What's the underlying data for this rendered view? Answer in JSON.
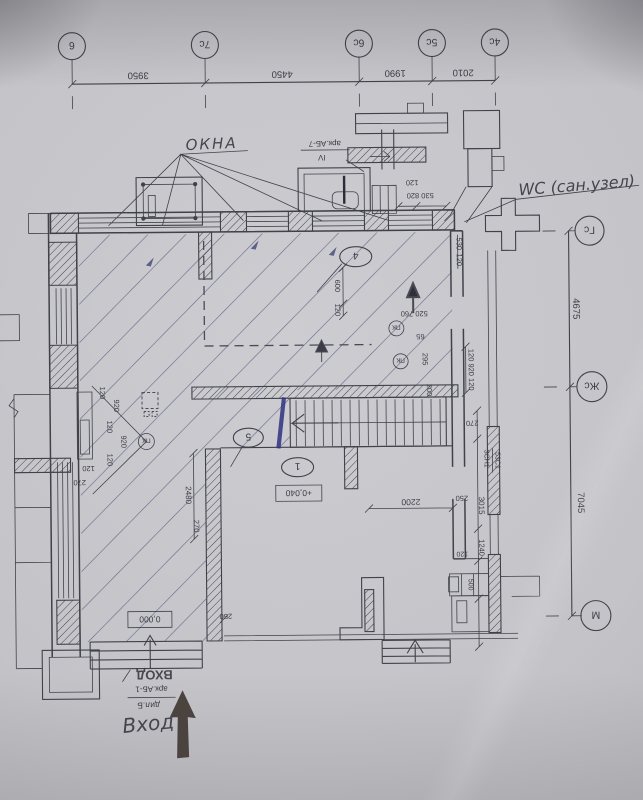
{
  "annotations": {
    "okna": "ОКНА",
    "wc": "WC (сан.узел)",
    "entrance": "Вход",
    "entrance_blue": "ВХОД",
    "ark_ab7": "арк.АБ-7",
    "roman_iv": "IV",
    "ark_ab1": "арк.АБ-1",
    "dil_b": "дил.Б"
  },
  "grid_top": {
    "bubbles": [
      "6",
      "7с",
      "6с",
      "5с",
      "4с"
    ],
    "dims": [
      "3950",
      "4450",
      "1990",
      "2010"
    ]
  },
  "grid_right": {
    "bubbles": [
      "Гс",
      "Жс",
      "М"
    ],
    "dims": [
      "4675",
      "7045"
    ]
  },
  "levels": {
    "entrance_zero": "0,000",
    "floor_plus": "+0,040"
  },
  "room_tags": {
    "porch": "4",
    "stair": "5",
    "hall": "1"
  },
  "circled": {
    "pk1": "ПК",
    "pk2": "ПК",
    "pk3": "ПК"
  },
  "wall_labels": {
    "zsn1": "ЗСН1",
    "s531": "53С1"
  },
  "dims": {
    "top_120": "120",
    "top_530_820": "530 820",
    "r530": "530",
    "r120a": "120",
    "chain_r": "120 920 120",
    "v600": "600",
    "v120": "120",
    "s520_760": "520 760",
    "s65": "65",
    "s295": "295",
    "s200": "200",
    "lc1": "120",
    "lc2": "920",
    "lc3": "120",
    "lc4": "920",
    "lc5": "120",
    "bl120": "120",
    "bl270": "270",
    "v2480": "2480",
    "m270": "270",
    "m250": "250",
    "d2200": "2200",
    "rr270": "270",
    "rr250": "250",
    "rr3015": "3015",
    "rr1240": "1240",
    "rr120": "120",
    "rr500": "500"
  }
}
